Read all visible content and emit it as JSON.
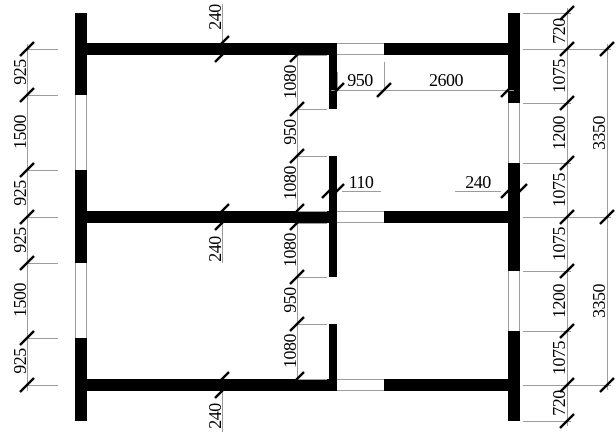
{
  "drawing": {
    "type": "floor-plan",
    "units": "mm",
    "left_chain": [
      "925",
      "1500",
      "925",
      "925",
      "1500",
      "925"
    ],
    "interior_chain": [
      "1080",
      "950",
      "1080",
      "1080",
      "950",
      "1080"
    ],
    "right_chain": [
      "720",
      "1075",
      "1200",
      "1075",
      "1075",
      "1200",
      "1075",
      "720"
    ],
    "right_overall": [
      "3350",
      "3350"
    ],
    "top_dims": [
      "950",
      "2600"
    ],
    "callouts": {
      "top_wall": "240",
      "middle_wall": "240",
      "bottom_wall": "240",
      "partition_wall": "110",
      "right_wall": "240"
    }
  },
  "colors": {
    "wall": "#000000",
    "thin_line": "#9c9c9c",
    "tick": "#000000",
    "text": "#000000",
    "background": "#ffffff"
  }
}
